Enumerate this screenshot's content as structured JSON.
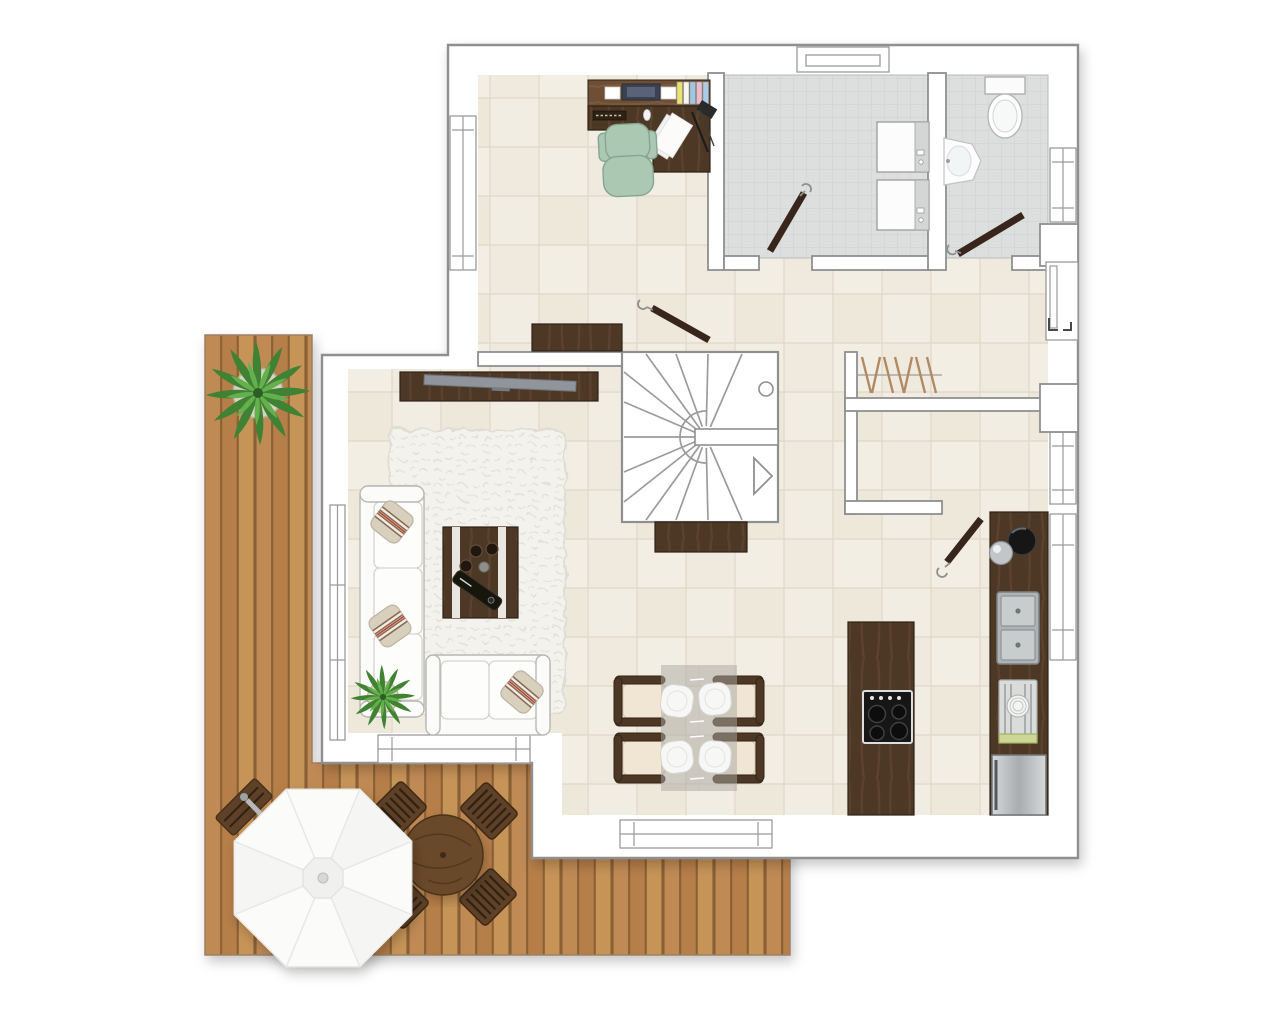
{
  "canvas": {
    "width": 1280,
    "height": 1025,
    "background": "#ffffff"
  },
  "colors": {
    "wall-fill": "#ffffff",
    "wall-stroke": "#8f8f8f",
    "win-stroke": "#9a9a9a",
    "stairs-line": "#9b9b9b",
    "floor-beige-a": "#f2ede2",
    "floor-beige-b": "#eee8db",
    "floor-beige-c": "#efe9de",
    "floor-beige-d": "#f3eee3",
    "floor-beige-line": "#e0d8c8",
    "floor-gray": "#dcdfde",
    "floor-gray-line": "#cdd0cf",
    "deck-plank-a": "#c08a55",
    "deck-plank-b": "#b67e49",
    "deck-plank-c": "#c79459",
    "deck-gap": "#8a6136",
    "deck-edge": "#9b8062",
    "wood-dark": "#4e3827",
    "wood-grain": "#5e4631",
    "wood-edge": "#2f2115",
    "wood-mid": "#6e5035",
    "wood-mid-grain": "#7d5d3f",
    "wood-outdoor": "#5f4128",
    "wood-outdoor-slat": "#2f2212",
    "table-outdoor": "#6b4a2c",
    "chair-teal": "#abc8b2",
    "chair-teal-stroke": "#86a593",
    "rug": "#f4f2ed",
    "rug-line": "#e3e0d8",
    "sofa": "#fbfbfa",
    "sofa-stroke": "#b9b7b2",
    "pillow": "#d9cfbd",
    "pillow-stroke": "#bdb2a0",
    "pillow-stripe": "#8a6b52",
    "pillow-stripe2": "#b7452f",
    "tv": "#8f959b",
    "glass": "#aaa7a1",
    "plate": "#f7f7f5",
    "seat-cream": "#f1e6d4",
    "seat-cream-stroke": "#d9c8ae",
    "cooktop": "#161616",
    "burner": "#0d0d0d",
    "sink-frame": "#aeb3b5",
    "sink-basin": "#c9cccd",
    "steel-a": "#d6d8d9",
    "steel-b": "#a9adaf",
    "rack-mat": "#ccd795",
    "umbrella": "#fbfbfa",
    "umbrella-seam": "#e8e8e6",
    "umbrella-panel": "#f3f3f1",
    "pole": "#b6b9ba",
    "leaf-dark": "#3f8233",
    "leaf-light": "#63b04c",
    "pot": "#d8d2c2",
    "door-wood": "#38281b",
    "handle": "#8f8f8f",
    "monitor": "#3a4350",
    "book-yellow": "#e9e370",
    "book-white": "#f7f5ee",
    "book-blue": "#9ec7e6",
    "book-pink": "#eabccd",
    "book-blue2": "#a9cde9",
    "coat-hanger": "#b08a64"
  },
  "elements": {
    "outdoor": [
      "terrace-deck",
      "potted-plant-large",
      "parasol",
      "outdoor-table",
      "outdoor-chairs",
      "outdoor-bench"
    ],
    "rooms": [
      "office-hall-area",
      "utility-room",
      "bathroom",
      "living-room",
      "dining-area",
      "kitchen-area",
      "storage-nook",
      "staircase"
    ],
    "furniture": [
      "office-desk",
      "office-chair",
      "desk-monitor",
      "desk-books",
      "washer",
      "dryer",
      "toilet",
      "corner-sink",
      "coat-rack",
      "hall-sideboard",
      "stairs-sideboard",
      "tv-sideboard",
      "television",
      "sofa",
      "loveseat",
      "shag-rug",
      "coffee-table",
      "potted-plant-small",
      "dining-table",
      "dining-chairs",
      "dinner-plates",
      "kitchen-island",
      "cooktop",
      "kitchen-counter",
      "coffee-machine",
      "double-sink",
      "dish-rack",
      "stainless-appliance"
    ],
    "openings": [
      "front-door",
      "hall-door",
      "utility-door",
      "bathroom-door",
      "kitchen-door",
      "windows"
    ]
  }
}
